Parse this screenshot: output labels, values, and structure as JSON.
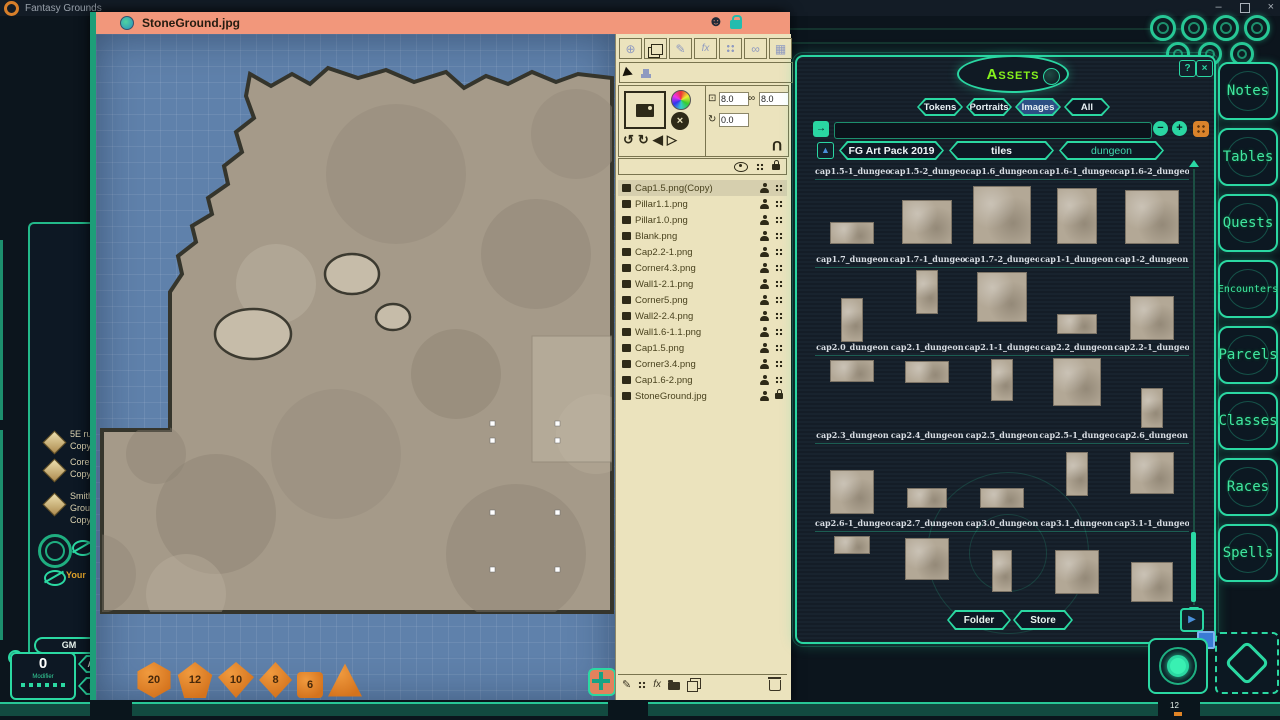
{
  "colors": {
    "accent_teal": "#2bd8a2",
    "salmon": "#f2977b",
    "cream": "#ebe3bd",
    "lime": "#86f21c",
    "orange_die": "#e0812a",
    "map_blue": "#5f81ab",
    "tab_active_blue": "#2d4f84"
  },
  "os": {
    "app_title": "Fantasy Grounds",
    "minimize": "–",
    "close": "×"
  },
  "icons": {
    "smiley": "☻",
    "globe": "⊕",
    "brush": "✎",
    "fx": "fx",
    "mask": "∞",
    "grid_sq": "▦",
    "undo": "↺",
    "redo": "↻",
    "flip_l": "◀",
    "flip_r": "▷",
    "resize": "⊡",
    "link": "∞",
    "rotate": "↻",
    "magnet": "U",
    "search_go": "→",
    "minus": "−",
    "plus": "+",
    "help": "?",
    "close_x": "×",
    "up_arrow": "▲",
    "play": "▶",
    "pencil": "✎",
    "fx2": "fx"
  },
  "map_window": {
    "title": "StoneGround.jpg",
    "tools": {
      "width_value": "8.0",
      "height_value": "8.0",
      "rotation_value": "0.0"
    },
    "layers": [
      {
        "name": "Cap1.5.png(Copy)",
        "cls": "selected"
      },
      {
        "name": "Pillar1.1.png",
        "cls": ""
      },
      {
        "name": "Pillar1.0.png",
        "cls": ""
      },
      {
        "name": "Blank.png",
        "cls": ""
      },
      {
        "name": "Cap2.2-1.png",
        "cls": ""
      },
      {
        "name": "Corner4.3.png",
        "cls": ""
      },
      {
        "name": "Wall1-2.1.png",
        "cls": ""
      },
      {
        "name": "Corner5.png",
        "cls": ""
      },
      {
        "name": "Wall2-2.4.png",
        "cls": ""
      },
      {
        "name": "Wall1.6-1.1.png",
        "cls": ""
      },
      {
        "name": "Cap1.5.png",
        "cls": ""
      },
      {
        "name": "Corner3.4.png",
        "cls": ""
      },
      {
        "name": "Cap1.6-2.png",
        "cls": ""
      },
      {
        "name": "StoneGround.jpg",
        "cls": "locked"
      }
    ],
    "dice": [
      {
        "label": "20",
        "shape": "d20"
      },
      {
        "label": "12",
        "shape": "d12"
      },
      {
        "label": "10",
        "shape": "d10"
      },
      {
        "label": "8",
        "shape": "d8"
      },
      {
        "label": "6",
        "shape": "d6"
      },
      {
        "label": "",
        "shape": "d4"
      }
    ]
  },
  "assets": {
    "title": "Assets",
    "tabs": [
      {
        "label": "Tokens",
        "cls": ""
      },
      {
        "label": "Portraits",
        "cls": ""
      },
      {
        "label": "Images",
        "cls": "active"
      },
      {
        "label": "All",
        "cls": ""
      }
    ],
    "search_value": "",
    "breadcrumb": [
      {
        "label": "FG Art Pack 2019",
        "cls": ""
      },
      {
        "label": "tiles",
        "cls": ""
      },
      {
        "label": "dungeon",
        "cls": "teal"
      }
    ],
    "label_rows": [
      [
        "cap1.5-1_dungeo",
        "cap1.5-2_dungeo",
        "cap1.6_dungeon",
        "cap1.6-1_dungeo",
        "cap1.6-2_dungeo"
      ],
      [
        "cap1.7_dungeon",
        "cap1.7-1_dungeo",
        "cap1.7-2_dungeo",
        "cap1-1_dungeon",
        "cap1-2_dungeon"
      ],
      [
        "cap2.0_dungeon",
        "cap2.1_dungeon",
        "cap2.1-1_dungeo",
        "cap2.2_dungeon",
        "cap2.2-1_dungeo"
      ],
      [
        "cap2.3_dungeon",
        "cap2.4_dungeon",
        "cap2.5_dungeon",
        "cap2.5-1_dungeo",
        "cap2.6_dungeon"
      ],
      [
        "cap2.6-1_dungeo",
        "cap2.7_dungeon",
        "cap3.0_dungeon",
        "cap3.1_dungeon",
        "cap3.1-1_dungeo"
      ]
    ],
    "thumb_rows": [
      [
        {
          "w": 44,
          "h": 22,
          "dy": 42
        },
        {
          "w": 50,
          "h": 44,
          "dy": 20
        },
        {
          "w": 58,
          "h": 58,
          "dy": 6
        },
        {
          "w": 40,
          "h": 56,
          "dy": 8
        },
        {
          "w": 54,
          "h": 54,
          "dy": 10
        }
      ],
      [
        {
          "w": 22,
          "h": 44,
          "dy": 30
        },
        {
          "w": 22,
          "h": 44,
          "dy": 2
        },
        {
          "w": 50,
          "h": 50,
          "dy": 4
        },
        {
          "w": 40,
          "h": 20,
          "dy": 46
        },
        {
          "w": 44,
          "h": 44,
          "dy": 28
        }
      ],
      [
        {
          "w": 44,
          "h": 22,
          "dy": 4
        },
        {
          "w": 44,
          "h": 22,
          "dy": 5
        },
        {
          "w": 22,
          "h": 42,
          "dy": 3
        },
        {
          "w": 48,
          "h": 48,
          "dy": 2
        },
        {
          "w": 22,
          "h": 40,
          "dy": 32
        }
      ],
      [
        {
          "w": 44,
          "h": 44,
          "dy": 26
        },
        {
          "w": 40,
          "h": 20,
          "dy": 44
        },
        {
          "w": 44,
          "h": 20,
          "dy": 44
        },
        {
          "w": 22,
          "h": 44,
          "dy": 8
        },
        {
          "w": 44,
          "h": 42,
          "dy": 8
        }
      ],
      [
        {
          "w": 36,
          "h": 18,
          "dy": 4
        },
        {
          "w": 44,
          "h": 42,
          "dy": 6
        },
        {
          "w": 20,
          "h": 42,
          "dy": 18
        },
        {
          "w": 44,
          "h": 44,
          "dy": 18
        },
        {
          "w": 42,
          "h": 40,
          "dy": 30
        }
      ]
    ],
    "folder_label": "Folder",
    "store_label": "Store"
  },
  "sidebar": {
    "items": [
      {
        "label": "Notes",
        "cls": ""
      },
      {
        "label": "Tables",
        "cls": ""
      },
      {
        "label": "Quests",
        "cls": ""
      },
      {
        "label": "Encounters",
        "cls": "small"
      },
      {
        "label": "Parcels",
        "cls": ""
      },
      {
        "label": "Classes",
        "cls": ""
      },
      {
        "label": "Races",
        "cls": ""
      },
      {
        "label": "Spells",
        "cls": ""
      }
    ]
  },
  "chat": {
    "entries": [
      {
        "l1": "5E ru",
        "l2": "Copy",
        "l3": ""
      },
      {
        "l1": "Core",
        "l2": "Copy",
        "l3": ""
      },
      {
        "l1": "Smith",
        "l2": "Grou",
        "l3": "Copy"
      }
    ],
    "your_label": "Your"
  },
  "hud": {
    "gm_label": "GM",
    "modifier_value": "0",
    "modifier_label": "Modifier",
    "adv_label": "ADV",
    "dis_label": "DIS"
  },
  "taskbar": {
    "slot_label": "12"
  }
}
